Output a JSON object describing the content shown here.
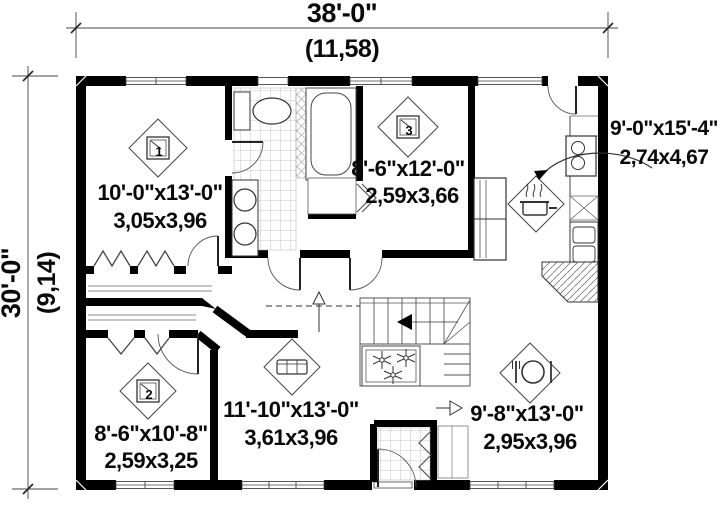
{
  "dimensions": {
    "overall_width_ft": "38'-0\"",
    "overall_width_m": "(11,58)",
    "overall_depth_ft": "30'-0\"",
    "overall_depth_m": "(9,14)"
  },
  "rooms": {
    "bedroom1": {
      "number": "1",
      "size_ft": "10'-0\"x13'-0\"",
      "size_m": "3,05x3,96"
    },
    "bedroom2": {
      "number": "2",
      "size_ft": "8'-6\"x10'-8\"",
      "size_m": "2,59x3,25"
    },
    "bedroom3": {
      "number": "3",
      "size_ft": "8'-6\"x12'-0\"",
      "size_m": "2,59x3,66"
    },
    "kitchen": {
      "size_ft": "9'-0\"x15'-4\"",
      "size_m": "2,74x4,67"
    },
    "living_room": {
      "size_ft": "11'-10\"x13'-0\"",
      "size_m": "3,61x3,96"
    },
    "dining_room": {
      "size_ft": "9'-8\"x13'-0\"",
      "size_m": "2,95x3,96"
    }
  },
  "icons": {
    "bedroom_marker": "numbered-square-diamond",
    "kitchen_marker": "cooking-pot-diamond",
    "living_marker": "sofa-diamond",
    "dining_marker": "place-setting-diamond",
    "stairs_direction": "down-arrow",
    "planter": "flowers"
  },
  "colors": {
    "wall": "#000000",
    "line": "#444444",
    "tile_line": "#b5b5b5",
    "text": "#0a0a0a",
    "background": "#ffffff"
  }
}
